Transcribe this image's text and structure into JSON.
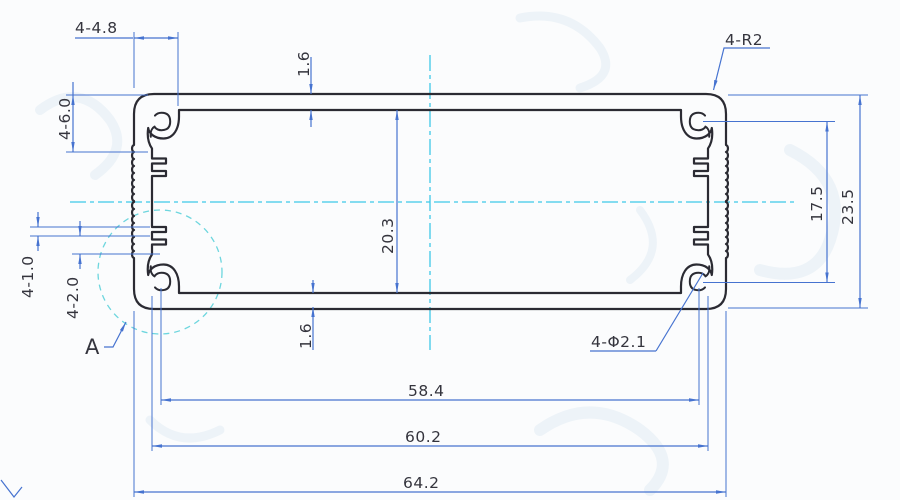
{
  "title": "Aluminum extrusion enclosure profile cross-section drawing",
  "colors": {
    "profile_line": "#2b2b33",
    "dimension_line": "#4673d0",
    "centerline": "#3ec8e8",
    "detail_circle": "#54cfd8",
    "text": "#34343d",
    "background": "#fbfcfd"
  },
  "labels": {
    "slot_offset_top": "4-4.8",
    "corner_radius": "4-R2",
    "wall_top": "1.6",
    "boss_depth": "4-6.0",
    "inner_height": "20.3",
    "hole_pitch_vertical": "17.5",
    "overall_height": "23.5",
    "rib_thickness": "4-1.0",
    "slot_width": "4-2.0",
    "wall_bottom": "1.6",
    "screw_hole": "4-Φ2.1",
    "hole_pitch_horizontal": "58.4",
    "inner_width": "60.2",
    "overall_width": "64.2",
    "detail_marker": "A"
  }
}
